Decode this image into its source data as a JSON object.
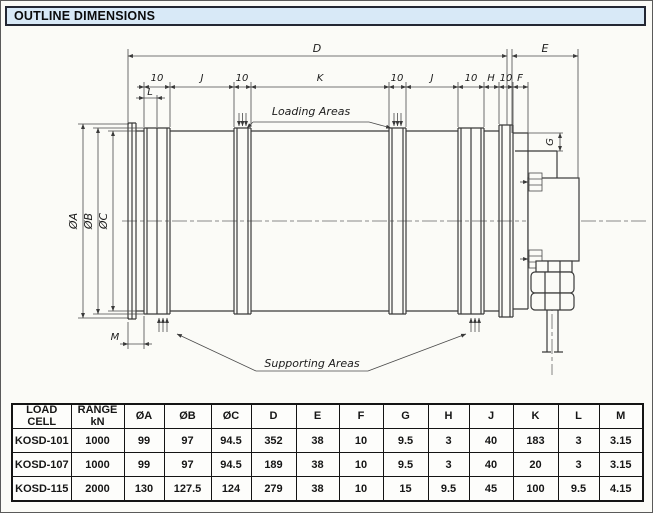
{
  "page": {
    "title": "OUTLINE DIMENSIONS"
  },
  "drawing": {
    "labels": {
      "d": "D",
      "e": "E",
      "ten": "10",
      "j": "J",
      "k": "K",
      "h": "H",
      "f": "F",
      "l": "L",
      "m": "M",
      "g": "G",
      "dia_a": "ØA",
      "dia_b": "ØB",
      "dia_c": "ØC"
    },
    "callouts": {
      "loading": "Loading Areas",
      "supporting": "Supporting Areas"
    }
  },
  "table": {
    "headers": [
      "LOAD\nCELL",
      "RANGE\nkN",
      "ØA",
      "ØB",
      "ØC",
      "D",
      "E",
      "F",
      "G",
      "H",
      "J",
      "K",
      "L",
      "M"
    ],
    "rows": [
      [
        "KOSD-101",
        "1000",
        "99",
        "97",
        "94.5",
        "352",
        "38",
        "10",
        "9.5",
        "3",
        "40",
        "183",
        "3",
        "3.15"
      ],
      [
        "KOSD-107",
        "1000",
        "99",
        "97",
        "94.5",
        "189",
        "38",
        "10",
        "9.5",
        "3",
        "40",
        "20",
        "3",
        "3.15"
      ],
      [
        "KOSD-115",
        "2000",
        "130",
        "127.5",
        "124",
        "279",
        "38",
        "10",
        "15",
        "9.5",
        "45",
        "100",
        "9.5",
        "4.15"
      ]
    ]
  }
}
